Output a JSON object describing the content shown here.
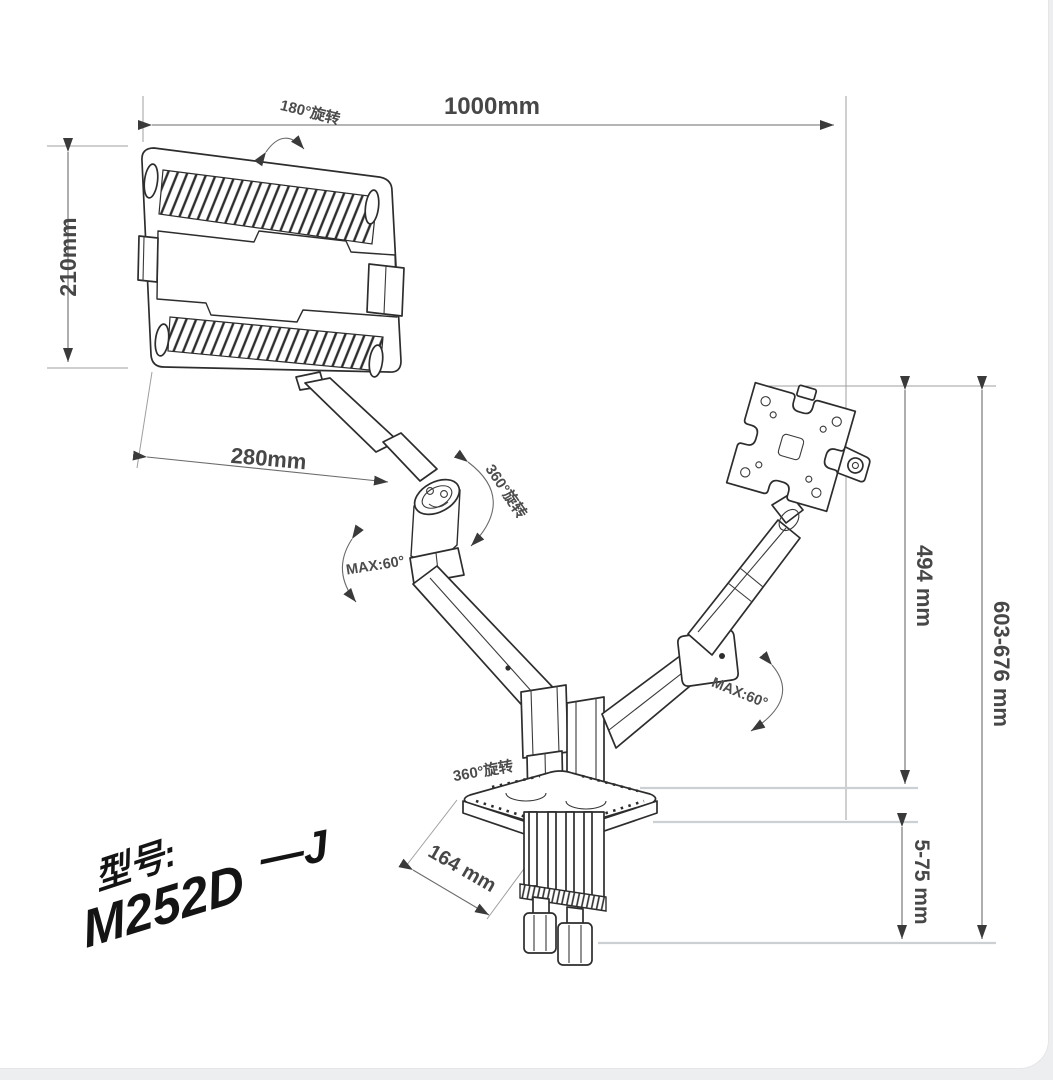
{
  "page": {
    "background": "#eceef0",
    "card_background": "#ffffff"
  },
  "diagram": {
    "type": "product-dimension-drawing",
    "subject": "dual arm desk mount with laptop tray and VESA plate",
    "dimensions": {
      "width_total": "1000mm",
      "tray_height": "210mm",
      "upper_arm_length": "280mm",
      "pole_height": "494 mm",
      "total_height_range": "603-676 mm",
      "base_depth": "164 mm",
      "clamp_thickness_range": "5-75 mm"
    },
    "annotations": {
      "tray_rotation": "180°旋转",
      "arm_rotation": "360°旋转",
      "base_rotation": "360°旋转",
      "max_tilt_left": "MAX:60°",
      "max_tilt_right": "MAX:60°"
    },
    "handwriting": {
      "model_label": "型号:",
      "model_number": "M252D",
      "model_suffix": "—J"
    },
    "colors": {
      "drawing_line": "#2d2d2d",
      "dimension_line": "#6b6b6b",
      "extension_line_light": "#ccd0d3",
      "text": "#474747"
    }
  }
}
